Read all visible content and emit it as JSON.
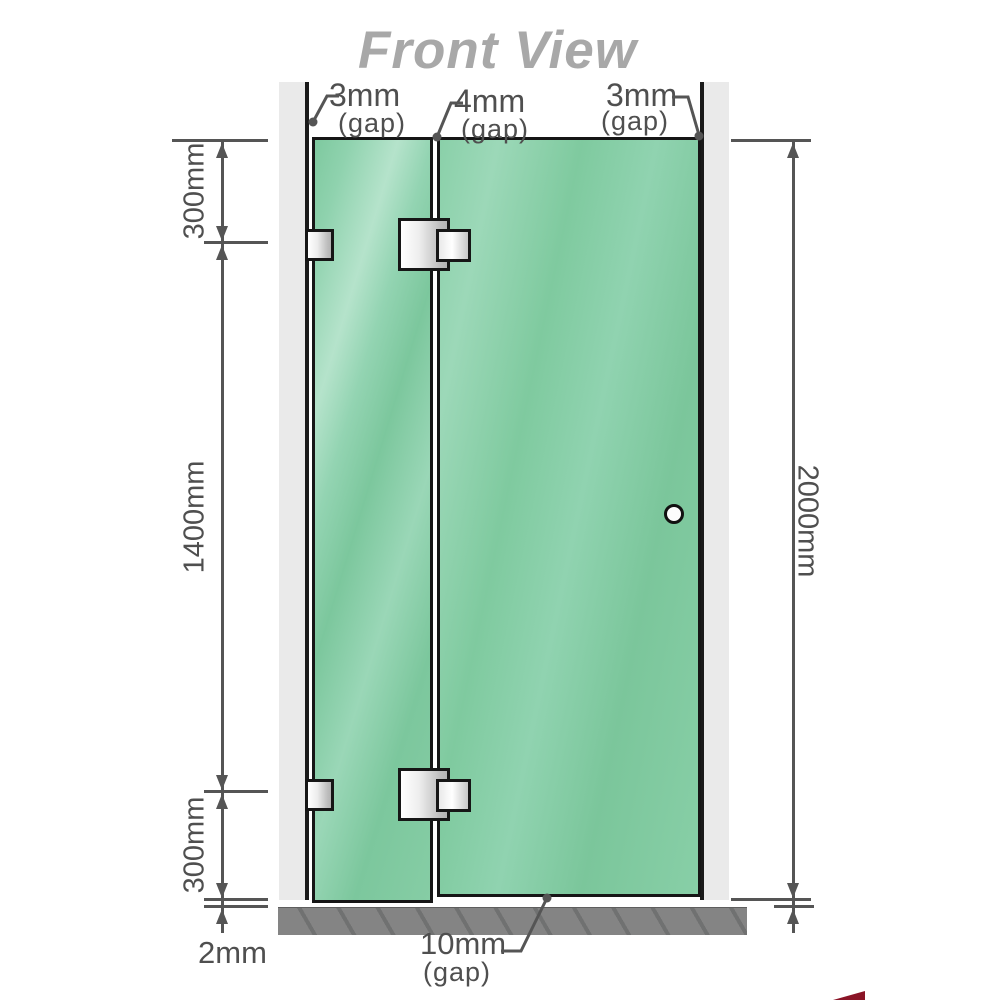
{
  "title": "Front View",
  "annotations": {
    "gap_left": {
      "value": "3mm",
      "suffix": "(gap)"
    },
    "gap_middle": {
      "value": "4mm",
      "suffix": "(gap)"
    },
    "gap_right": {
      "value": "3mm",
      "suffix": "(gap)"
    },
    "gap_floor": {
      "value": "10mm",
      "suffix": "(gap)"
    }
  },
  "dimensions": {
    "left_top": "300mm",
    "left_middle": "1400mm",
    "left_bottom": "300mm",
    "floor_gap_left": "2mm",
    "right_height": "2000mm"
  },
  "colors": {
    "line": "#555555",
    "text": "#4f4f4f",
    "title": "#a8a8a8",
    "glass": "#82cba3",
    "wall": "#eaeaea",
    "floor": "#848484",
    "floor_hatch": "#707171",
    "red": "#8a1426"
  }
}
